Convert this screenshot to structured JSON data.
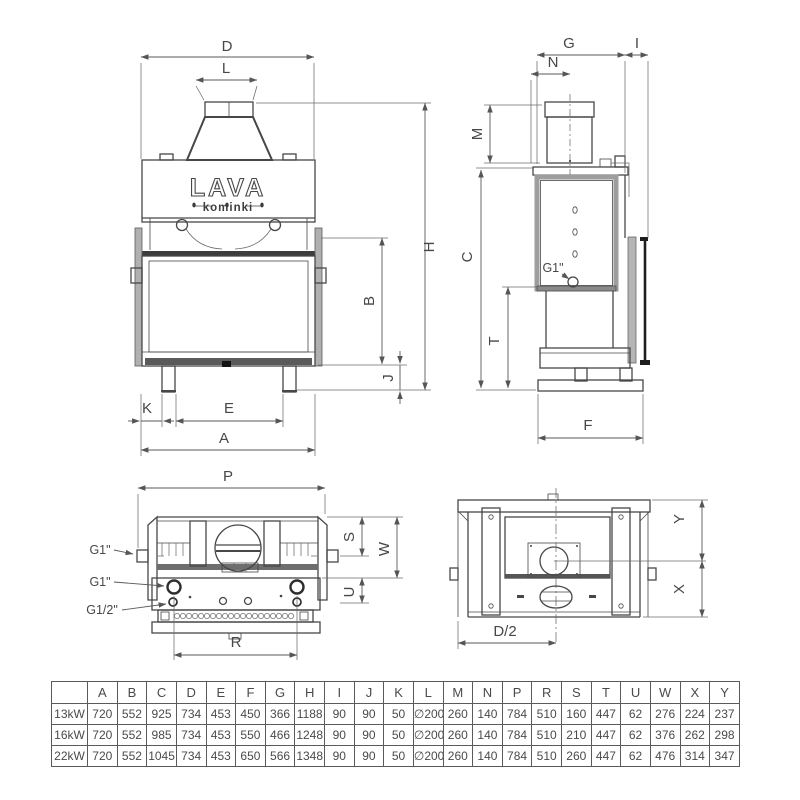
{
  "brand": {
    "name": "LAVA",
    "subtitle": "kominki"
  },
  "front_view": {
    "dims": {
      "d": "D",
      "l": "L",
      "h": "H",
      "b": "B",
      "j": "J",
      "k": "K",
      "e": "E",
      "a": "A"
    }
  },
  "side_view": {
    "dims": {
      "g": "G",
      "i": "I",
      "n": "N",
      "m": "M",
      "c": "C",
      "t": "T",
      "f": "F"
    },
    "port_g1": "G1\""
  },
  "top_view": {
    "dims": {
      "p": "P",
      "s": "S",
      "w": "W",
      "u": "U",
      "r": "R"
    },
    "ports": {
      "side": "G1\"",
      "supply": "G1\"",
      "half": "G1/2\""
    }
  },
  "underside_view": {
    "dims": {
      "y": "Y",
      "x": "X",
      "d2": "D/2"
    }
  },
  "table": {
    "headers": [
      "",
      "A",
      "B",
      "C",
      "D",
      "E",
      "F",
      "G",
      "H",
      "I",
      "J",
      "K",
      "L",
      "M",
      "N",
      "P",
      "R",
      "S",
      "T",
      "U",
      "W",
      "X",
      "Y"
    ],
    "rows": [
      {
        "label": "13kW",
        "values": [
          "720",
          "552",
          "925",
          "734",
          "453",
          "450",
          "366",
          "1188",
          "90",
          "90",
          "50",
          "∅200",
          "260",
          "140",
          "784",
          "510",
          "160",
          "447",
          "62",
          "276",
          "224",
          "237"
        ]
      },
      {
        "label": "16kW",
        "values": [
          "720",
          "552",
          "985",
          "734",
          "453",
          "550",
          "466",
          "1248",
          "90",
          "90",
          "50",
          "∅200",
          "260",
          "140",
          "784",
          "510",
          "210",
          "447",
          "62",
          "376",
          "262",
          "298"
        ]
      },
      {
        "label": "22kW",
        "values": [
          "720",
          "552",
          "1045",
          "734",
          "453",
          "650",
          "566",
          "1348",
          "90",
          "90",
          "50",
          "∅200",
          "260",
          "140",
          "784",
          "510",
          "260",
          "447",
          "62",
          "476",
          "314",
          "347"
        ]
      }
    ]
  }
}
